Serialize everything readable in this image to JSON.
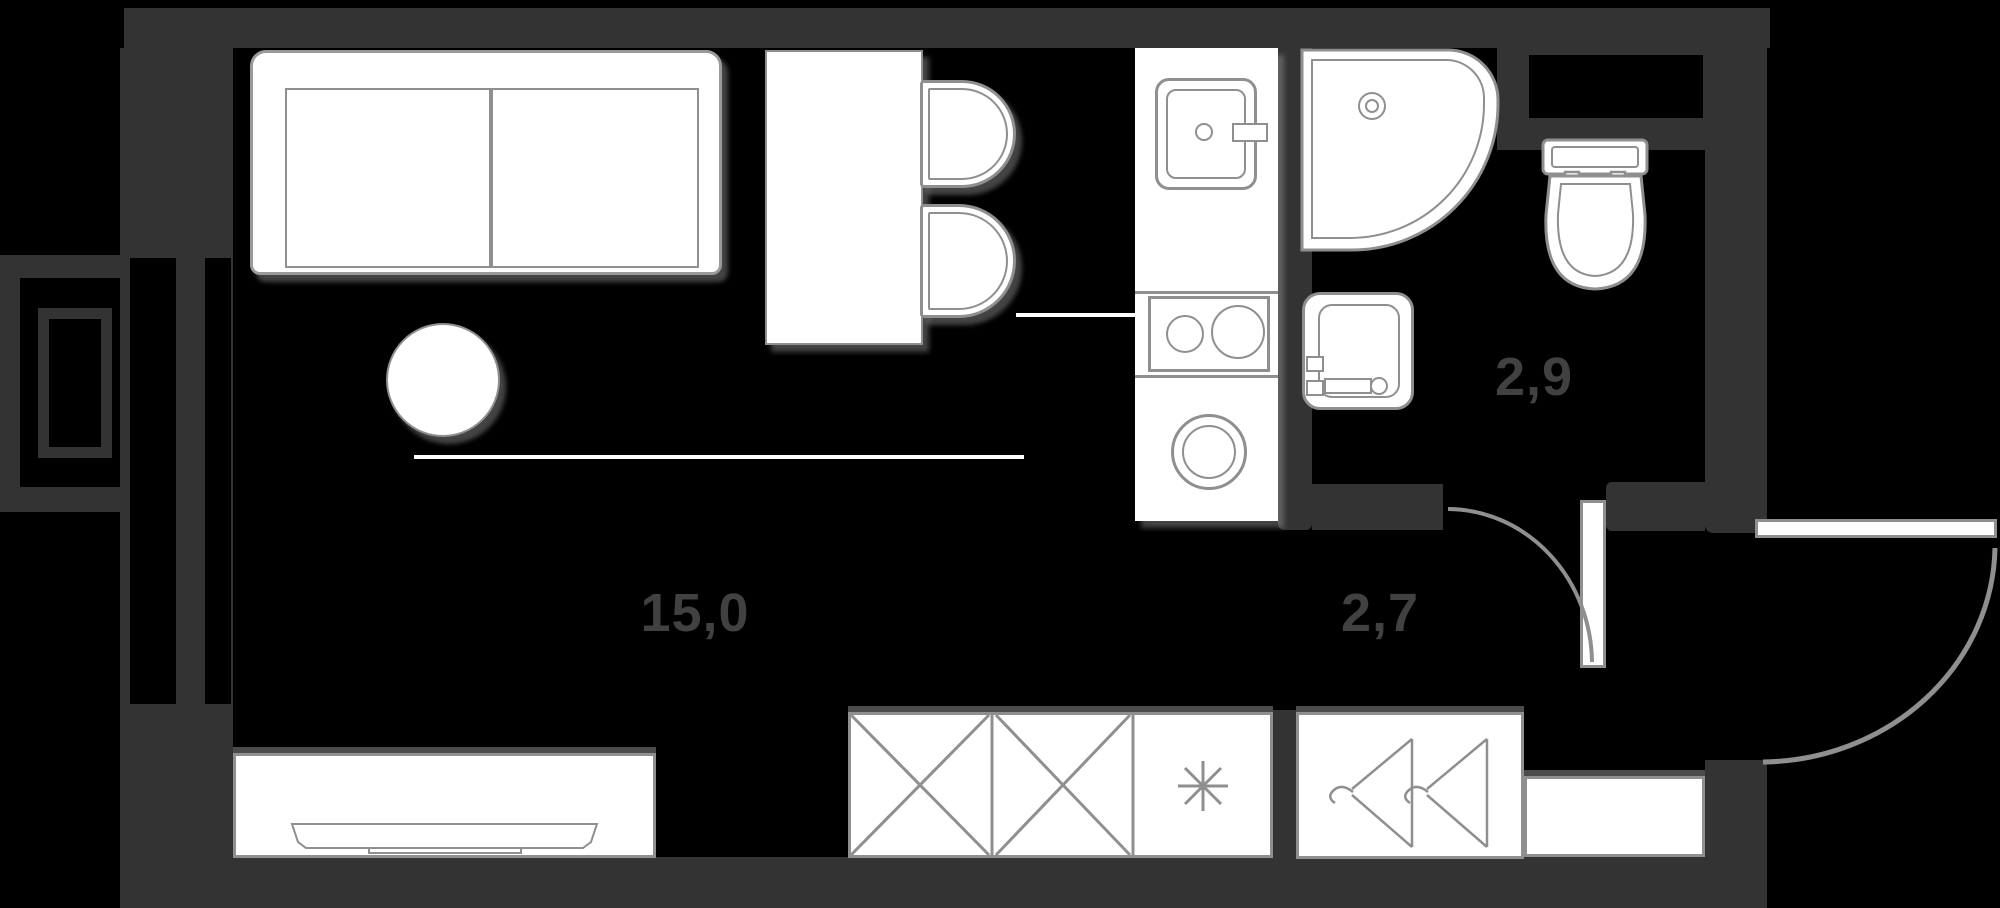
{
  "plan": {
    "title": "studio-apartment-floor-plan",
    "colors": {
      "background": "#000000",
      "wall": "#333333",
      "furniture_fill": "#ffffff",
      "furniture_outline": "#8f8f8f",
      "area_label": "#414141",
      "shadow": "#969696"
    },
    "rooms": [
      {
        "name": "living-room",
        "area_label": "15,0"
      },
      {
        "name": "hallway",
        "area_label": "2,7"
      },
      {
        "name": "bathroom",
        "area_label": "2,9"
      }
    ],
    "symbols": {
      "freezer_asterisk": "✳"
    },
    "fixtures": [
      "sofa",
      "round-table",
      "dining-table",
      "chair",
      "chair",
      "kitchen-sink",
      "stove",
      "washing-machine",
      "shower",
      "wash-basin",
      "toilet",
      "wardrobe",
      "freezer-cabinet",
      "hanger-closet",
      "shelf",
      "tv-stand",
      "balcony",
      "window",
      "entrance-door",
      "bathroom-door"
    ]
  }
}
